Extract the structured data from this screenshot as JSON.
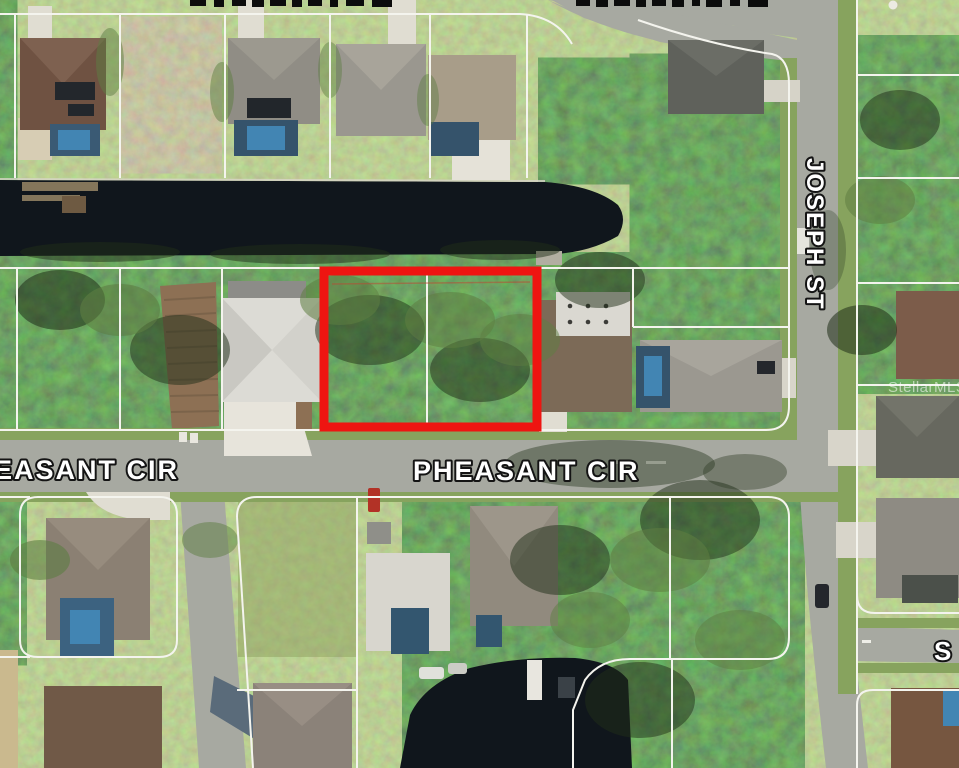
{
  "map": {
    "description": "Aerial MLS parcel map with subject vacant lot outlined in red near a canal",
    "watermark_text": "StellarMLS",
    "highlight": {
      "color": "#ee1511"
    },
    "street_labels": {
      "pheasant_cir_left": "EASANT CIR",
      "pheasant_cir_center": "PHEASANT CIR",
      "joseph_st": "JOSEPH ST",
      "truncated_right_street": "S"
    },
    "palette": {
      "water": "#10161c",
      "road": "#a7a9a1",
      "grass": "#7d9b5c",
      "woods": "#33482a",
      "parcel_line": "#f4f4ee",
      "label_fill": "#ffffff",
      "label_stroke": "#141414"
    }
  }
}
